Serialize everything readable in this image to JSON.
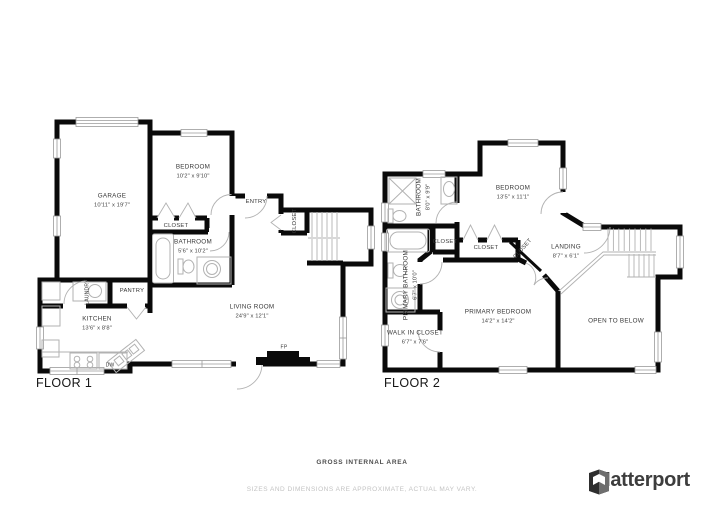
{
  "floor1": {
    "label": "FLOOR 1",
    "rooms": {
      "garage": {
        "name": "GARAGE",
        "dims": "10'11\" x 19'7\""
      },
      "bedroom": {
        "name": "BEDROOM",
        "dims": "10'2\" x 9'10\""
      },
      "entry": {
        "name": "ENTRY"
      },
      "bedroom_closet": {
        "name": "CLOSET"
      },
      "hall_closet": {
        "name": "CLOSET"
      },
      "bathroom": {
        "name": "BATHROOM",
        "dims": "5'6\" x 10'2\""
      },
      "pantry": {
        "name": "PANTRY"
      },
      "laundry": {
        "name": "LAUNDRY"
      },
      "kitchen": {
        "name": "KITCHEN",
        "dims": "13'6\" x 8'8\""
      },
      "living_room": {
        "name": "LIVING ROOM",
        "dims": "24'9\" x 12'1\""
      },
      "dishwasher": {
        "name": "DW"
      },
      "fireplace": {
        "name": "FP"
      }
    }
  },
  "floor2": {
    "label": "FLOOR 2",
    "rooms": {
      "bathroom": {
        "name": "BATHROOM",
        "dims": "8'0\" x 9'9\""
      },
      "bedroom": {
        "name": "BEDROOM",
        "dims": "13'5\" x 11'1\""
      },
      "closet_a": {
        "name": "CLOSET"
      },
      "closet_b": {
        "name": "CLOSET"
      },
      "closet_c": {
        "name": "CLOSET"
      },
      "landing": {
        "name": "LANDING",
        "dims": "8'7\" x 6'1\""
      },
      "primary_bathroom": {
        "name": "PRIMARY BATHROOM",
        "dims": "6'7\" x 10'0\""
      },
      "walk_in_closet": {
        "name": "WALK IN CLOSET",
        "dims": "6'7\" x 7'6\""
      },
      "primary_bedroom": {
        "name": "PRIMARY BEDROOM",
        "dims": "14'2\" x 14'2\""
      },
      "open_to_below": {
        "name": "OPEN TO BELOW"
      }
    }
  },
  "footer": {
    "area_title": "GROSS INTERNAL AREA",
    "disclaimer": "SIZES AND DIMENSIONS ARE APPROXIMATE, ACTUAL MAY VARY.",
    "brand": "Matterport"
  },
  "colors": {
    "wall": "#0a0a0a",
    "fixture": "#b2b2b2",
    "label_text": "#383838",
    "disclaimer_text": "#c3c3c3",
    "brand_text": "#3d3d3d"
  }
}
